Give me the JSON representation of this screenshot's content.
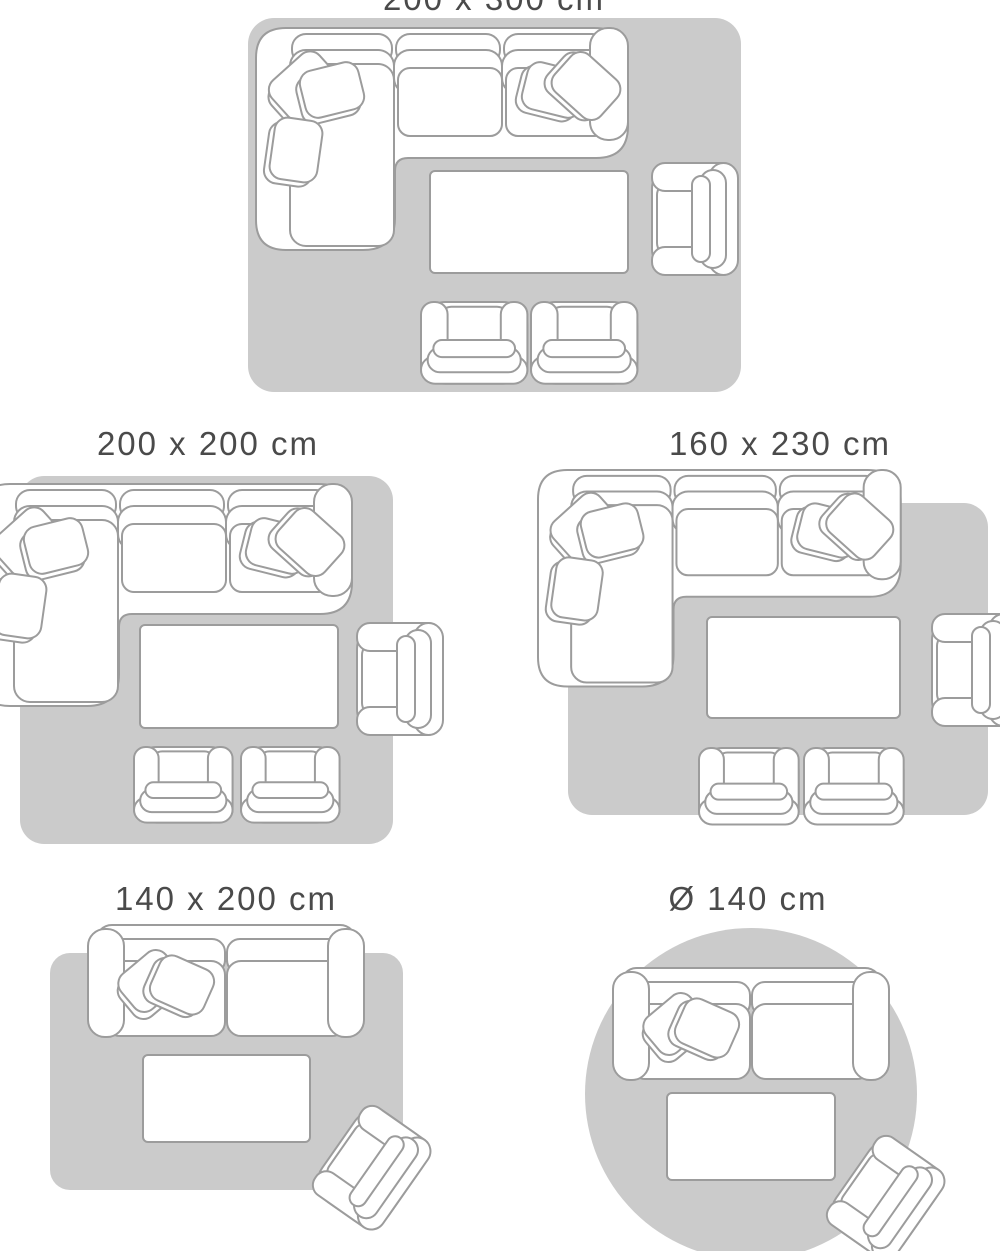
{
  "page_title": "Rug size guide",
  "palette": {
    "background": "#ffffff",
    "rug_fill": "#cbcbcb",
    "furniture_fill": "#ffffff",
    "furniture_outline": "#9c9c9c",
    "title_color": "#4a4a4a"
  },
  "layouts": [
    {
      "title": "200 x 300 cm",
      "rug_shape": "rectangle",
      "items": [
        "corner-sofa",
        "coffee-table",
        "armchair",
        "armchair",
        "armchair"
      ]
    },
    {
      "title": "200 x 200 cm",
      "rug_shape": "rectangle",
      "items": [
        "corner-sofa",
        "coffee-table",
        "armchair",
        "armchair",
        "armchair"
      ]
    },
    {
      "title": "160 x 230 cm",
      "rug_shape": "rectangle",
      "items": [
        "corner-sofa",
        "coffee-table",
        "armchair",
        "armchair",
        "armchair"
      ]
    },
    {
      "title": "140 x 200 cm",
      "rug_shape": "rectangle",
      "items": [
        "sofa",
        "coffee-table",
        "armchair"
      ]
    },
    {
      "title": "Ø 140 cm",
      "rug_shape": "circle",
      "items": [
        "sofa",
        "coffee-table",
        "armchair"
      ]
    }
  ]
}
